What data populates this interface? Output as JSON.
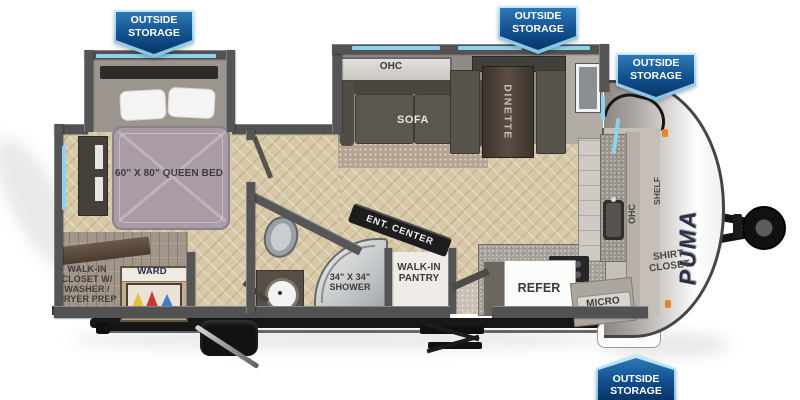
{
  "banners": [
    {
      "id": "top-left",
      "label": "OUTSIDE STORAGE"
    },
    {
      "id": "top-center",
      "label": "OUTSIDE STORAGE"
    },
    {
      "id": "front-right",
      "label": "OUTSIDE STORAGE"
    },
    {
      "id": "bottom-right",
      "label": "OUTSIDE STORAGE"
    }
  ],
  "floorplan": {
    "bedroom": {
      "bed_label": "60\" X 80\" QUEEN BED"
    },
    "closet": {
      "label": "WALK-IN CLOSET W/ WASHER / DRYER PREP",
      "ward_label": "WARD"
    },
    "bathroom": {
      "shower_label": "34\" X 34\" SHOWER"
    },
    "living": {
      "ohc_label": "OHC",
      "sofa_label": "SOFA",
      "dinette_label": "DINETTE",
      "ent_center_label": "ENT. CENTER"
    },
    "kitchen": {
      "pantry_label": "WALK-IN PANTRY",
      "refer_label": "REFER",
      "micro_label": "MICRO",
      "ohc_label": "OHC"
    },
    "front": {
      "shelf_label": "SHELF",
      "shirt_closet_label": "SHIRT CLOSET",
      "brand_label": "PUMA"
    }
  },
  "colors": {
    "banner_blue": "#11508f",
    "banner_blue_dark": "#0a3566",
    "banner_edge_blue": "#9adcf8",
    "window_blue": "#8ed2ef",
    "wall_gray": "#525252",
    "floor_tan": "#d7c9a7",
    "mattress_lavender": "#a99ca7",
    "hanger_yellow": "#e6c23a",
    "hanger_red": "#c53a31",
    "hanger_blue": "#3d7fc4",
    "marker_orange": "#e8862a"
  }
}
